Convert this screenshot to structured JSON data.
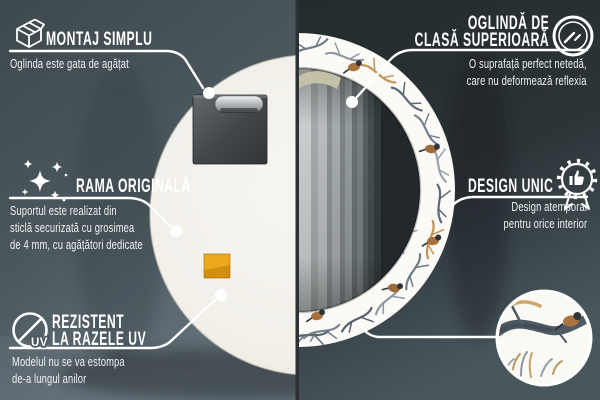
{
  "callouts": {
    "montaj": {
      "icon": "package-box-icon",
      "title": "MONTAJ SIMPLU",
      "subtitle": "Oglinda este gata de agățat"
    },
    "oglinda": {
      "icon": "mirror-shine-icon",
      "title_lines": [
        "OGLINDĂ DE",
        "CLASĂ SUPERIOARĂ"
      ],
      "subtitle_lines": [
        "O suprafață perfect netedă,",
        "care nu deformează reflexia"
      ]
    },
    "rama": {
      "icon": "sparkles-icon",
      "title": "RAMA ORIGINALĂ",
      "subtitle_lines": [
        "Suportul este realizat din",
        "sticlă securizată cu grosimea",
        "de 4 mm, cu agățători dedicate"
      ]
    },
    "rezistent": {
      "icon": "uv-protection-icon",
      "icon_label": "UV",
      "title_lines": [
        "REZISTENT",
        "LA RAZELE UV"
      ],
      "subtitle_lines": [
        "Modelul nu se va estompa",
        "de-a lungul anilor"
      ]
    },
    "design": {
      "icon": "award-badge-icon",
      "title": "DESIGN UNIC",
      "subtitle_lines": [
        "Design atemporal",
        "pentru orice interior"
      ]
    }
  },
  "detail_icon": "pattern-detail-zoom-circle",
  "colors": {
    "background_left": "#4a575d",
    "background_right": "#2a3335",
    "callout_line": "#ffffff",
    "heading_text": "#ffffff",
    "subtitle_text": "#f1f1f1",
    "mirror_back": "#f1efe8",
    "frame_pattern_base": "#fbfaf6",
    "mirror_glass": "#20262a",
    "sticker_orange": "#eda71d"
  }
}
